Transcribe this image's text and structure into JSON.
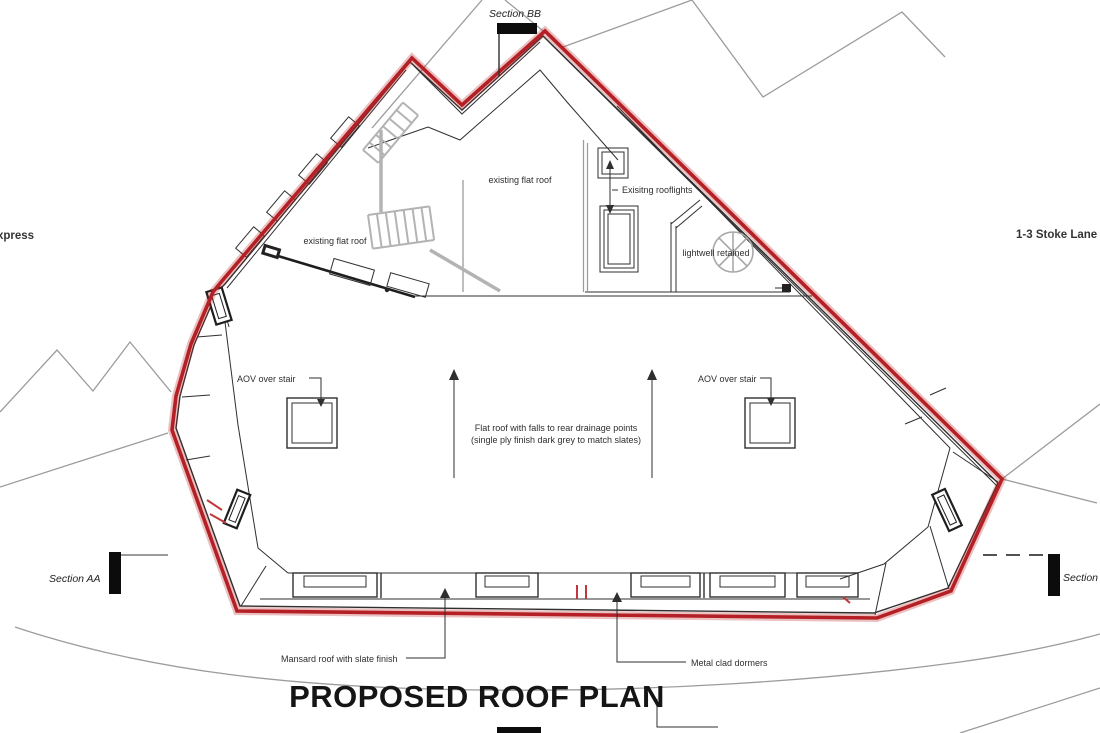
{
  "title": "PROPOSED ROOF PLAN",
  "colors": {
    "outline_red": "#b42025",
    "outline_red_glow": "rgba(183,28,28,0.28)",
    "line_black": "#2f2f2f",
    "line_gray": "#9c9c9c"
  },
  "context_labels": {
    "left_street": "xpress",
    "right_street": "1-3 Stoke Lane"
  },
  "sections": {
    "top": "Section BB",
    "left": "Section AA",
    "right": "Section AA"
  },
  "annotations": {
    "existing_flat_roof_center": "existing flat roof",
    "existing_flat_roof_left": "existing flat roof",
    "existing_rooflights": "Exisitng rooflights",
    "lightwell": "lightwell retained",
    "aov_left": "AOV over stair",
    "aov_right": "AOV over stair",
    "flat_roof_note_line1": "Flat roof with falls to rear drainage points",
    "flat_roof_note_line2": "(single ply finish dark grey to match slates)",
    "mansard": "Mansard roof with slate finish",
    "dormers": "Metal clad dormers"
  }
}
